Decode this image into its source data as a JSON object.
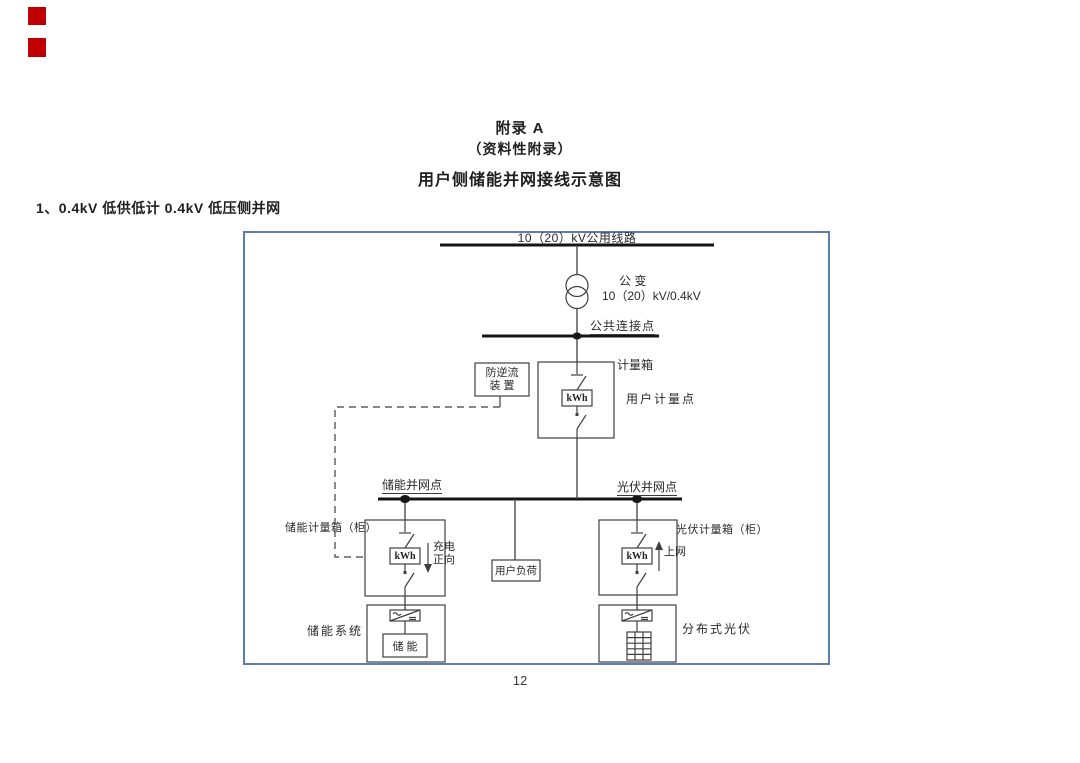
{
  "page": {
    "appendix_heading": "附录 A",
    "appendix_type": "（资料性附录）",
    "doc_title": "用户侧储能并网接线示意图",
    "section_heading": "1、0.4kV 低供低计 0.4kV 低压侧并网",
    "page_number": "12"
  },
  "colors": {
    "frame_border": "#5b7db1",
    "corner_marker_red": "#c00000",
    "diagram_line": "#3f3f3f",
    "bus_line": "#151515",
    "text": "#1f1f1f"
  },
  "diagram": {
    "top_bus_label": "10（20）kV公用线路",
    "transformer_name": "公 变",
    "transformer_ratio": "10（20）kV/0.4kV",
    "pcc_label": "公共连接点",
    "anti_backflow_line1": "防逆流",
    "anti_backflow_line2": "装 置",
    "meter_box_label": "计量箱",
    "user_meter_point_label": "用户计量点",
    "meter_unit": "kWh",
    "storage_poc_label": "储能并网点",
    "pv_poc_label": "光伏并网点",
    "storage_meter_box_label": "储能计量箱（柜）",
    "pv_meter_box_label": "光伏计量箱（柜）",
    "charge_dir_line1": "充电",
    "charge_dir_line2": "正向",
    "to_grid_label": "上网",
    "user_load_label": "用户负荷",
    "storage_system_label": "储能系统",
    "storage_unit_label": "储 能",
    "distributed_pv_label": "分布式光伏"
  }
}
